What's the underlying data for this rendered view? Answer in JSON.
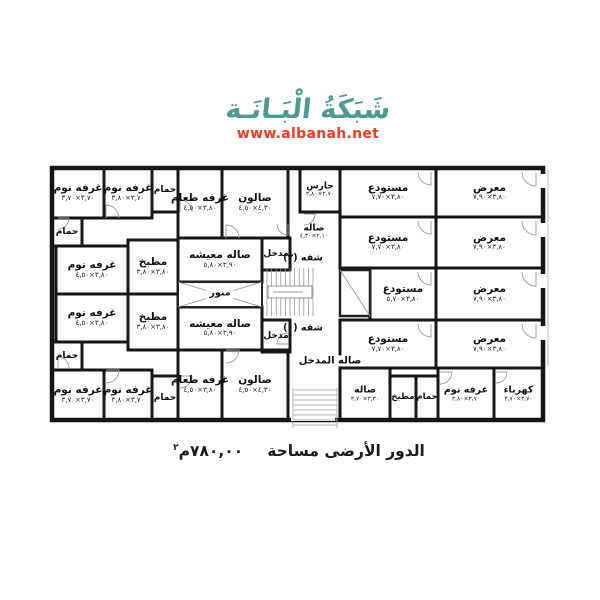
{
  "watermark": {
    "logo_text": "شَبَكَةُ الْبَـانَـة",
    "url": "www.albanah.net",
    "logo_color": "#4d9a94",
    "url_color": "#ee3a22"
  },
  "caption": {
    "text": "الدور الأرضى مساحة",
    "value": "٧٨٠,٠٠م",
    "sup": "٢"
  },
  "plan": {
    "wall_color": "#161616",
    "detail_color": "#9a9a9a",
    "text_color": "#111111",
    "outline": [
      52,
      168,
      491,
      252
    ],
    "rooms": [
      {
        "id": "bedroom-top-1",
        "label": "غرفه نوم",
        "dims": "٣,٧٠×٣,٧٠",
        "box": [
          52,
          168,
          52,
          50
        ]
      },
      {
        "id": "bedroom-top-2",
        "label": "غرفه نوم",
        "dims": "٣,٧٠×٣,٨٠",
        "box": [
          104,
          168,
          48,
          50
        ]
      },
      {
        "id": "bath-top-1",
        "label": "حمام",
        "box": [
          152,
          168,
          26,
          44
        ],
        "fs": 9
      },
      {
        "id": "dining-top",
        "label": "غرفه طعام",
        "dims": "٣,٨٠×٤,٥٠",
        "box": [
          178,
          168,
          44,
          70
        ]
      },
      {
        "id": "salon-top",
        "label": "صالون",
        "dims": "٤,٣٠×٤,٥٠",
        "box": [
          222,
          168,
          66,
          70
        ]
      },
      {
        "id": "guard-room",
        "label": "حارس",
        "dims": "٢,٧٠×٣,٨٠",
        "box": [
          300,
          168,
          40,
          44
        ],
        "fs": 9,
        "dfs": 6
      },
      {
        "id": "bath-top-2",
        "label": "حمام",
        "box": [
          52,
          218,
          30,
          28
        ],
        "fs": 9
      },
      {
        "id": "bedroom-top-3",
        "label": "غرفه نوم",
        "dims": "٣,٨٠×٤,٥٠",
        "box": [
          56,
          246,
          72,
          48
        ]
      },
      {
        "id": "kitchen-top",
        "label": "مطبخ",
        "dims": "٣,٨٠×٣,٨٠",
        "box": [
          128,
          240,
          50,
          54
        ]
      },
      {
        "id": "living-top",
        "label": "صاله معيشه",
        "dims": "٣,٩٠×٥,٨٠",
        "box": [
          178,
          238,
          84,
          44
        ]
      },
      {
        "id": "entry-apt2",
        "label": "مدخل",
        "box": [
          262,
          238,
          28,
          32
        ],
        "fs": 9
      },
      {
        "id": "living-bottom",
        "label": "صاله معيشه",
        "dims": "٣,٩٠×٥,٨٠",
        "box": [
          178,
          307,
          84,
          43
        ]
      },
      {
        "id": "kitchen-bottom",
        "label": "مطبخ",
        "dims": "٣,٨٠×٣,٨٠",
        "box": [
          128,
          294,
          50,
          56
        ]
      },
      {
        "id": "bedroom-bot-3",
        "label": "غرفه نوم",
        "dims": "٣,٨٠×٤,٥٠",
        "box": [
          56,
          294,
          72,
          48
        ]
      },
      {
        "id": "bath-bot-2",
        "label": "حمام",
        "box": [
          52,
          342,
          30,
          28
        ],
        "fs": 9
      },
      {
        "id": "bedroom-bot-1",
        "label": "غرفه نوم",
        "dims": "٣,٧٠×٣,٧٠",
        "box": [
          52,
          370,
          52,
          50
        ]
      },
      {
        "id": "bedroom-bot-2",
        "label": "غرفه نوم",
        "dims": "٣,٧٠×٣,٨٠",
        "box": [
          104,
          370,
          48,
          50
        ]
      },
      {
        "id": "bath-bot-1",
        "label": "حمام",
        "box": [
          152,
          376,
          26,
          44
        ],
        "fs": 9
      },
      {
        "id": "dining-bottom",
        "label": "غرفه طعام",
        "dims": "٣,٨٠×٤,٥٠",
        "box": [
          178,
          350,
          44,
          70
        ]
      },
      {
        "id": "salon-bottom",
        "label": "صالون",
        "dims": "٤,٣٠×٤,٥٠",
        "box": [
          222,
          350,
          66,
          70
        ]
      },
      {
        "id": "entry-apt1",
        "label": "مدخل",
        "box": [
          262,
          320,
          28,
          32
        ],
        "fs": 9
      },
      {
        "id": "storage-1",
        "label": "مستودع",
        "dims": "٣,٨٠×٧,٧٠",
        "box": [
          340,
          168,
          96,
          49
        ]
      },
      {
        "id": "storage-2",
        "label": "مستودع",
        "dims": "٣,٨٠×٧,٧٠",
        "box": [
          340,
          217,
          96,
          51
        ]
      },
      {
        "id": "storage-3",
        "label": "مستودع",
        "dims": "٣,٨٠×٥,٧٠",
        "box": [
          370,
          268,
          66,
          52
        ]
      },
      {
        "id": "storage-4",
        "label": "مستودع",
        "dims": "٣,٨٠×٧,٧٠",
        "box": [
          340,
          320,
          96,
          48
        ]
      },
      {
        "id": "showroom-1",
        "label": "معرض",
        "dims": "٣,٨٠×٧,٩٠",
        "box": [
          436,
          168,
          107,
          49
        ]
      },
      {
        "id": "showroom-2",
        "label": "معرض",
        "dims": "٣,٨٠×٧,٩٠",
        "box": [
          436,
          217,
          107,
          51
        ]
      },
      {
        "id": "showroom-3",
        "label": "معرض",
        "dims": "٣,٨٠×٧,٩٠",
        "box": [
          436,
          268,
          107,
          52
        ]
      },
      {
        "id": "showroom-4",
        "label": "معرض",
        "dims": "٣,٨٠×٧,٩٠",
        "box": [
          436,
          320,
          107,
          48
        ]
      },
      {
        "id": "hall-bottom-right",
        "label": "صاله",
        "dims": "٣,٣٠×٣,٧٠",
        "box": [
          340,
          368,
          50,
          52
        ],
        "fs": 9.5,
        "dfs": 6
      },
      {
        "id": "kitchen-br",
        "label": "مطبخ",
        "box": [
          390,
          376,
          26,
          44
        ],
        "fs": 8.5
      },
      {
        "id": "bath-br",
        "label": "حمام",
        "box": [
          416,
          376,
          22,
          44
        ],
        "fs": 8.5
      },
      {
        "id": "bedroom-br",
        "label": "غرفه نوم",
        "dims": "٣,٧٠×٣,٨٠",
        "box": [
          438,
          368,
          56,
          52
        ],
        "fs": 9.5,
        "dfs": 6
      },
      {
        "id": "electricity-room",
        "label": "كهرباء",
        "dims": "٣,٧٠×٣,٧٠",
        "box": [
          494,
          368,
          49,
          52
        ],
        "fs": 9.5,
        "dfs": 6
      }
    ],
    "labels": [
      {
        "id": "hall-middle",
        "label": "صاله",
        "dims": "٢,١٠×٤,٣٠",
        "x": 314,
        "y": 232,
        "fs": 9,
        "dfs": 6
      },
      {
        "id": "apartment-2",
        "label": "شقه (٢)",
        "x": 303,
        "y": 259,
        "fs": 9.5
      },
      {
        "id": "apartment-1",
        "label": "شقه (١)",
        "x": 303,
        "y": 329,
        "fs": 9.5
      },
      {
        "id": "entrance-hall",
        "label": "صاله المدخل",
        "x": 330,
        "y": 361,
        "fs": 10,
        "bg": true
      },
      {
        "id": "lightwell",
        "label": "منور",
        "x": 220,
        "y": 294,
        "fs": 9.5,
        "bg": true
      }
    ],
    "features": {
      "stairs": [
        263,
        266,
        54,
        52
      ],
      "steps": [
        293,
        388,
        44,
        40
      ],
      "lightwell_box": [
        178,
        282,
        84,
        25
      ],
      "shaft_box": [
        340,
        270,
        30,
        46
      ],
      "sidewalk_line": [
        548,
        170,
        548,
        366
      ],
      "door_gaps": [
        [
          539,
          174,
          8,
          14
        ],
        [
          539,
          223,
          8,
          14
        ],
        [
          539,
          274,
          8,
          14
        ],
        [
          539,
          326,
          8,
          14
        ],
        [
          291,
          412,
          44,
          9
        ]
      ],
      "door_arcs": [
        [
          536,
          172,
          14,
          90
        ],
        [
          536,
          221,
          14,
          90
        ],
        [
          536,
          272,
          14,
          90
        ],
        [
          536,
          324,
          14,
          90
        ],
        [
          431,
          172,
          13,
          90
        ],
        [
          431,
          221,
          13,
          90
        ],
        [
          431,
          272,
          13,
          90
        ],
        [
          431,
          324,
          13,
          90
        ],
        [
          304,
          214,
          11,
          0
        ],
        [
          106,
          218,
          13,
          270
        ],
        [
          180,
          212,
          12,
          270
        ],
        [
          226,
          238,
          13,
          270
        ],
        [
          58,
          218,
          11,
          0
        ],
        [
          288,
          224,
          11,
          90
        ],
        [
          106,
          370,
          13,
          0
        ],
        [
          180,
          376,
          12,
          0
        ],
        [
          226,
          350,
          13,
          0
        ],
        [
          58,
          368,
          11,
          270
        ],
        [
          288,
          344,
          11,
          180
        ],
        [
          440,
          372,
          12,
          0
        ],
        [
          496,
          372,
          11,
          0
        ]
      ]
    }
  }
}
